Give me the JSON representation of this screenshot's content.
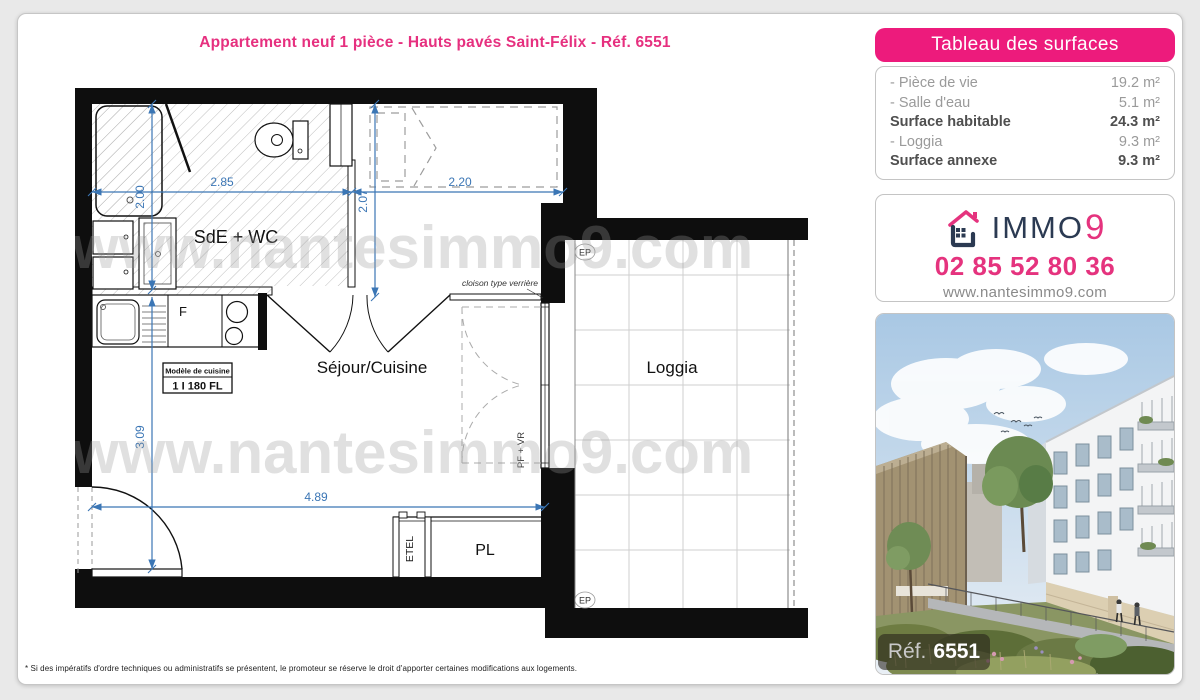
{
  "title": "Appartement neuf 1 pièce - Hauts pavés Saint-Félix - Réf. 6551",
  "surfaces_panel": {
    "header": "Tableau des surfaces",
    "rows": [
      {
        "label": "- Pièce de vie",
        "value": "19.2 m²"
      },
      {
        "label": "- Salle d'eau",
        "value": "5.1 m²"
      },
      {
        "label": "Surface habitable",
        "value": "24.3 m²"
      },
      {
        "label": "- Loggia",
        "value": "9.3 m²"
      },
      {
        "label": "Surface annexe",
        "value": "9.3 m²"
      }
    ]
  },
  "agency": {
    "brand_immo": "IMMO",
    "brand_9": "9",
    "phone": "02 85 52 80 36",
    "website": "www.nantesimmo9.com"
  },
  "photo": {
    "ref_label": "Réf.",
    "ref_number": "6551"
  },
  "plan": {
    "rooms": {
      "sde": "SdE + WC",
      "sejour": "Séjour/Cuisine",
      "loggia": "Loggia",
      "pl": "PL",
      "etel": "ETEL"
    },
    "dims": {
      "d285": "2.85",
      "d220": "2.20",
      "d200": "2.00",
      "d207": "2.07",
      "d309": "3.09",
      "d489": "4.89"
    },
    "annotations": {
      "cloison": "cloison type verrière",
      "pfvr": "PF + VR",
      "ep": "EP",
      "kitchen_model_1": "Modèle de cuisine",
      "kitchen_model_2": "1 I 180 FL",
      "fridge": "F"
    },
    "watermark": "www.nantesimmo9.com"
  },
  "footer": {
    "disclaimer": "* Si des impératifs d'ordre techniques ou administratifs se présentent, le promoteur se réserve le droit d'apporter certaines modifications aux logements."
  }
}
